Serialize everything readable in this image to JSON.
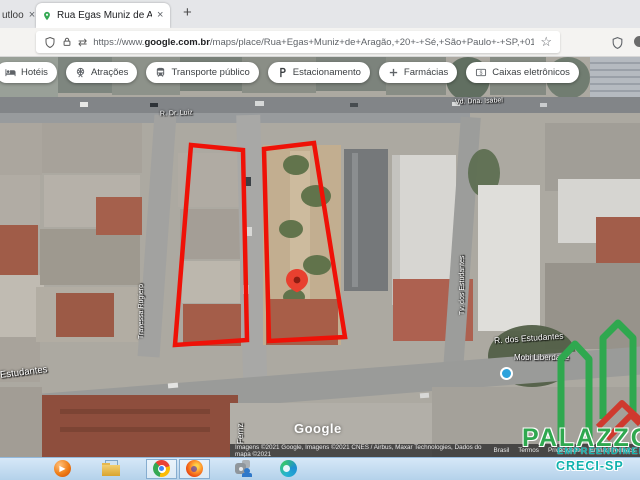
{
  "browser": {
    "partial_tab": {
      "title": "utloo",
      "close": "×"
    },
    "active_tab": {
      "title": "Rua Egas Muniz de Aragão, 20",
      "close": "×"
    },
    "new_tab_label": "+",
    "address": {
      "url_prefix": "https://www.",
      "url_domain": "google.com.br",
      "url_path": "/maps/place/Rua+Egas+Muniz+de+Aragão,+20+-+Sé,+São+Paulo+-+SP,+0150",
      "permissions_glyph": "⇄",
      "star": "☆"
    }
  },
  "chips": [
    {
      "label": "Hotéis"
    },
    {
      "label": "Atrações"
    },
    {
      "label": "Transporte público"
    },
    {
      "label": "Estacionamento"
    },
    {
      "label": "Farmácias"
    },
    {
      "label": "Caixas eletrônicos"
    }
  ],
  "map": {
    "street_labels": {
      "top": "R. Dr. Luiz",
      "top_right": "Vd. Dna. Isabel",
      "left_vertical": "Travessa Rugiero",
      "right_vertical": "Tv. dos Estudantes",
      "estudantes_left": "Estudantes",
      "estudantes_right": "R. dos Estudantes",
      "bottom_vertical": "Fernz"
    },
    "poi_label": "Mobi Liberdade",
    "google_logo": "Google",
    "attribution": {
      "text": "Imagens ©2021 Google, Imagens ©2021 CNES / Airbus, Maxar Technologies, Dados do mapa ©2021",
      "links": [
        "Brasil",
        "Termos",
        "Privacidade",
        "Enviar feedback"
      ]
    }
  },
  "watermark": {
    "name": "PALAZZO",
    "subtitle": "EMPREENDIMENTOS",
    "creci": "CRECI-SP"
  }
}
